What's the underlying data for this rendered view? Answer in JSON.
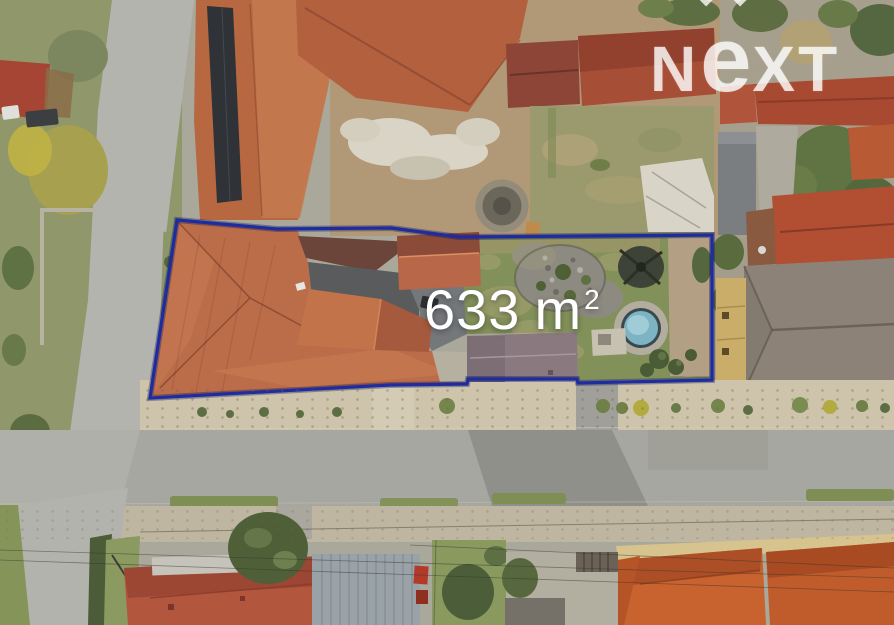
{
  "annotation": {
    "area_value": "633",
    "area_unit": "m",
    "area_exponent": "2",
    "text_color": "#ffffff",
    "boundary_color": "#1e2ca0"
  },
  "watermark": {
    "text": "NEXT",
    "letter_n": "N",
    "letter_e": "e",
    "letter_x": "X",
    "letter_t": "T",
    "color": "rgba(255,255,255,0.78)"
  }
}
